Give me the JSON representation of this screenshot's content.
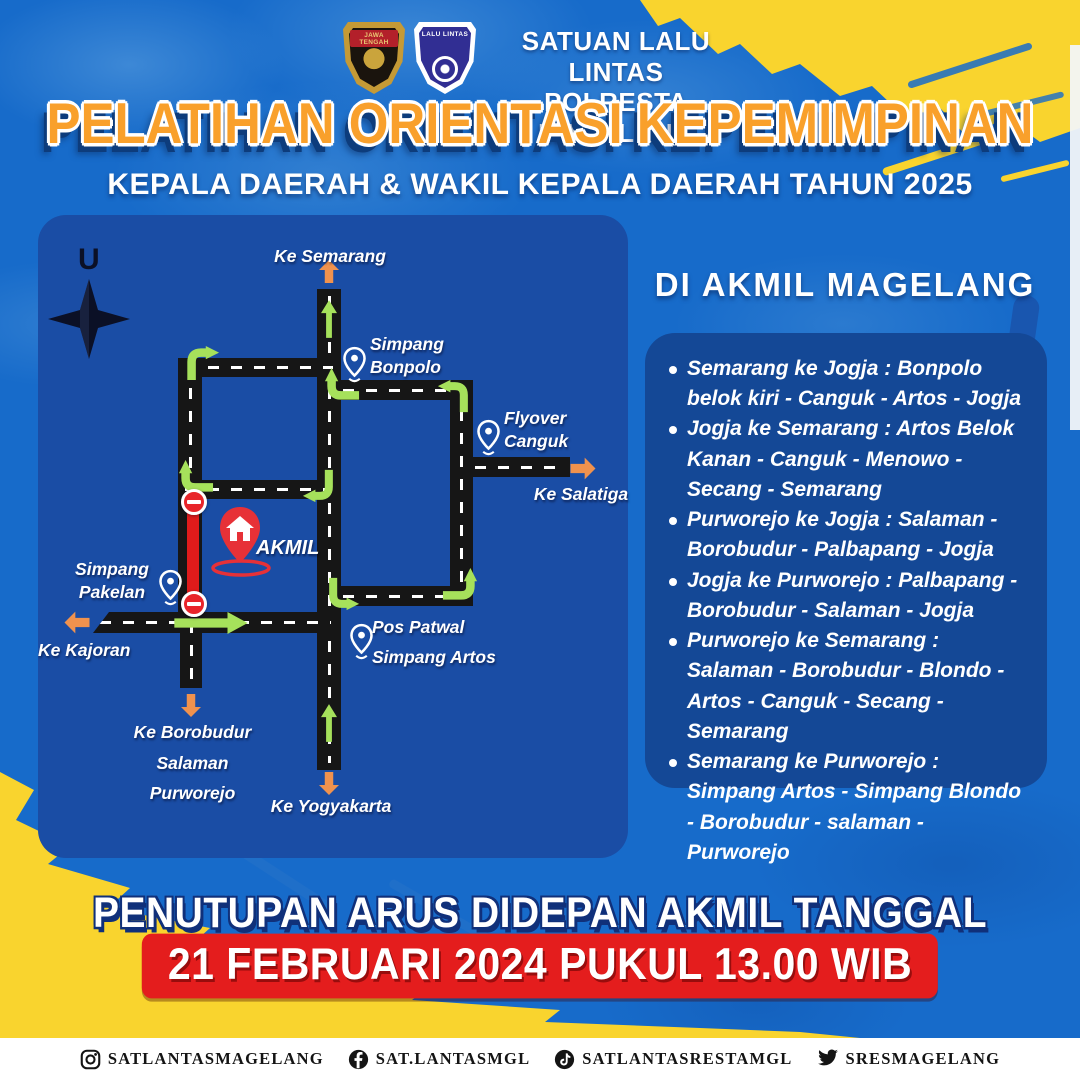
{
  "header": {
    "logo_left_banner": "JAWA TENGAH",
    "logo_right_banner": "LALU LINTAS",
    "org_line1": "SATUAN LALU LINTAS",
    "org_line2": "POLRESTA MAGELANG"
  },
  "title": {
    "main": "PELATIHAN ORIENTASI KEPEMIMPINAN",
    "subtitle": "KEPALA DAERAH & WAKIL KEPALA DAERAH TAHUN 2025"
  },
  "map": {
    "compass": "U",
    "akmil": "AKMIL",
    "dest_semarang": "Ke Semarang",
    "dest_salatiga": "Ke Salatiga",
    "dest_kajoran": "Ke Kajoran",
    "dest_borobudur_l1": "Ke Borobudur",
    "dest_borobudur_l2": "Salaman",
    "dest_borobudur_l3": "Purworejo",
    "dest_yogyakarta": "Ke Yogyakarta",
    "pin_bonpolo_l1": "Simpang",
    "pin_bonpolo_l2": "Bonpolo",
    "pin_canguk_l1": "Flyover",
    "pin_canguk_l2": "Canguk",
    "pin_pakelan_l1": "Simpang",
    "pin_pakelan_l2": "Pakelan",
    "pin_artos_l1": "Pos Patwal",
    "pin_artos_l2": "Simpang Artos"
  },
  "routes": {
    "heading": "DI AKMIL MAGELANG",
    "items": [
      "Semarang ke Jogja : Bonpolo belok kiri - Canguk - Artos - Jogja",
      "Jogja ke Semarang : Artos Belok Kanan - Canguk - Menowo - Secang - Semarang",
      "Purworejo ke Jogja : Salaman - Borobudur - Palbapang - Jogja",
      "Jogja ke Purworejo : Palbapang - Borobudur - Salaman - Jogja",
      "Purworejo ke Semarang : Salaman - Borobudur - Blondo - Artos - Canguk - Secang - Semarang",
      "Semarang ke Purworejo : Simpang Artos - Simpang Blondo - Borobudur - salaman - Purworejo"
    ]
  },
  "closure": {
    "line1": "PENUTUPAN ARUS DIDEPAN AKMIL TANGGAL",
    "banner": "21 FEBRUARI 2024 PUKUL 13.00 WIB"
  },
  "footer": {
    "items": [
      {
        "icon": "instagram-icon",
        "handle": "SATLANTASMAGELANG"
      },
      {
        "icon": "facebook-icon",
        "handle": "SAT.LANTASMGL"
      },
      {
        "icon": "tiktok-icon",
        "handle": "SATLANTASRESTAMGL"
      },
      {
        "icon": "twitter-icon",
        "handle": "SRESMAGELANG"
      }
    ]
  },
  "colors": {
    "background": "#176bca",
    "map_panel": "#1a4da5",
    "list_panel": "#144896",
    "yellow": "#f9d42e",
    "orange_arrow": "#f0924e",
    "green_arrow": "#a6e15b",
    "red": "#e41d1d",
    "road": "#161616"
  }
}
